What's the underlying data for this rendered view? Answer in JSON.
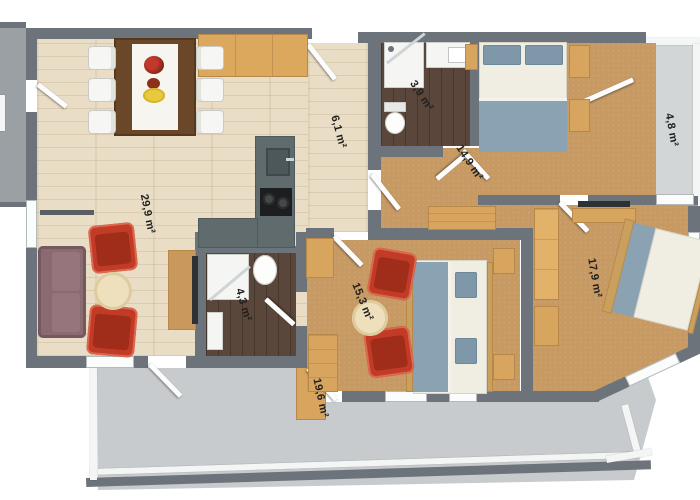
{
  "floorplan": {
    "type": "apartment-floor-plan-3d-top-view",
    "wall_color": "#6d737a",
    "rooms": [
      {
        "id": "living-dining-room",
        "area_label": "29,9 m²"
      },
      {
        "id": "kitchen",
        "area_label": "6,1 m²"
      },
      {
        "id": "bathroom-small",
        "area_label": "3,9 m²"
      },
      {
        "id": "bedroom-north",
        "area_label": "14,9 m²"
      },
      {
        "id": "balcony-east",
        "area_label": "4,8 m²"
      },
      {
        "id": "bedroom-east",
        "area_label": "17,9 m²"
      },
      {
        "id": "bedroom-center",
        "area_label": "15,3 m²"
      },
      {
        "id": "bathroom-ensuite",
        "area_label": "4,3 m²"
      },
      {
        "id": "terrace-south",
        "area_label": "19,6 m²"
      }
    ],
    "palette": {
      "wood_floor": "#e9ddc6",
      "carpet": "#c79a64",
      "bath_floor": "#5a463a",
      "terrace": "#c8cbcd",
      "balcony": "#d3d6d7",
      "counter": "#5f6b6c",
      "furniture_wood": "#d8a55f",
      "bed_blue": "#8aa2b2",
      "armchair_red": "#c23b27",
      "sofa_mauve": "#8a6b72"
    }
  }
}
